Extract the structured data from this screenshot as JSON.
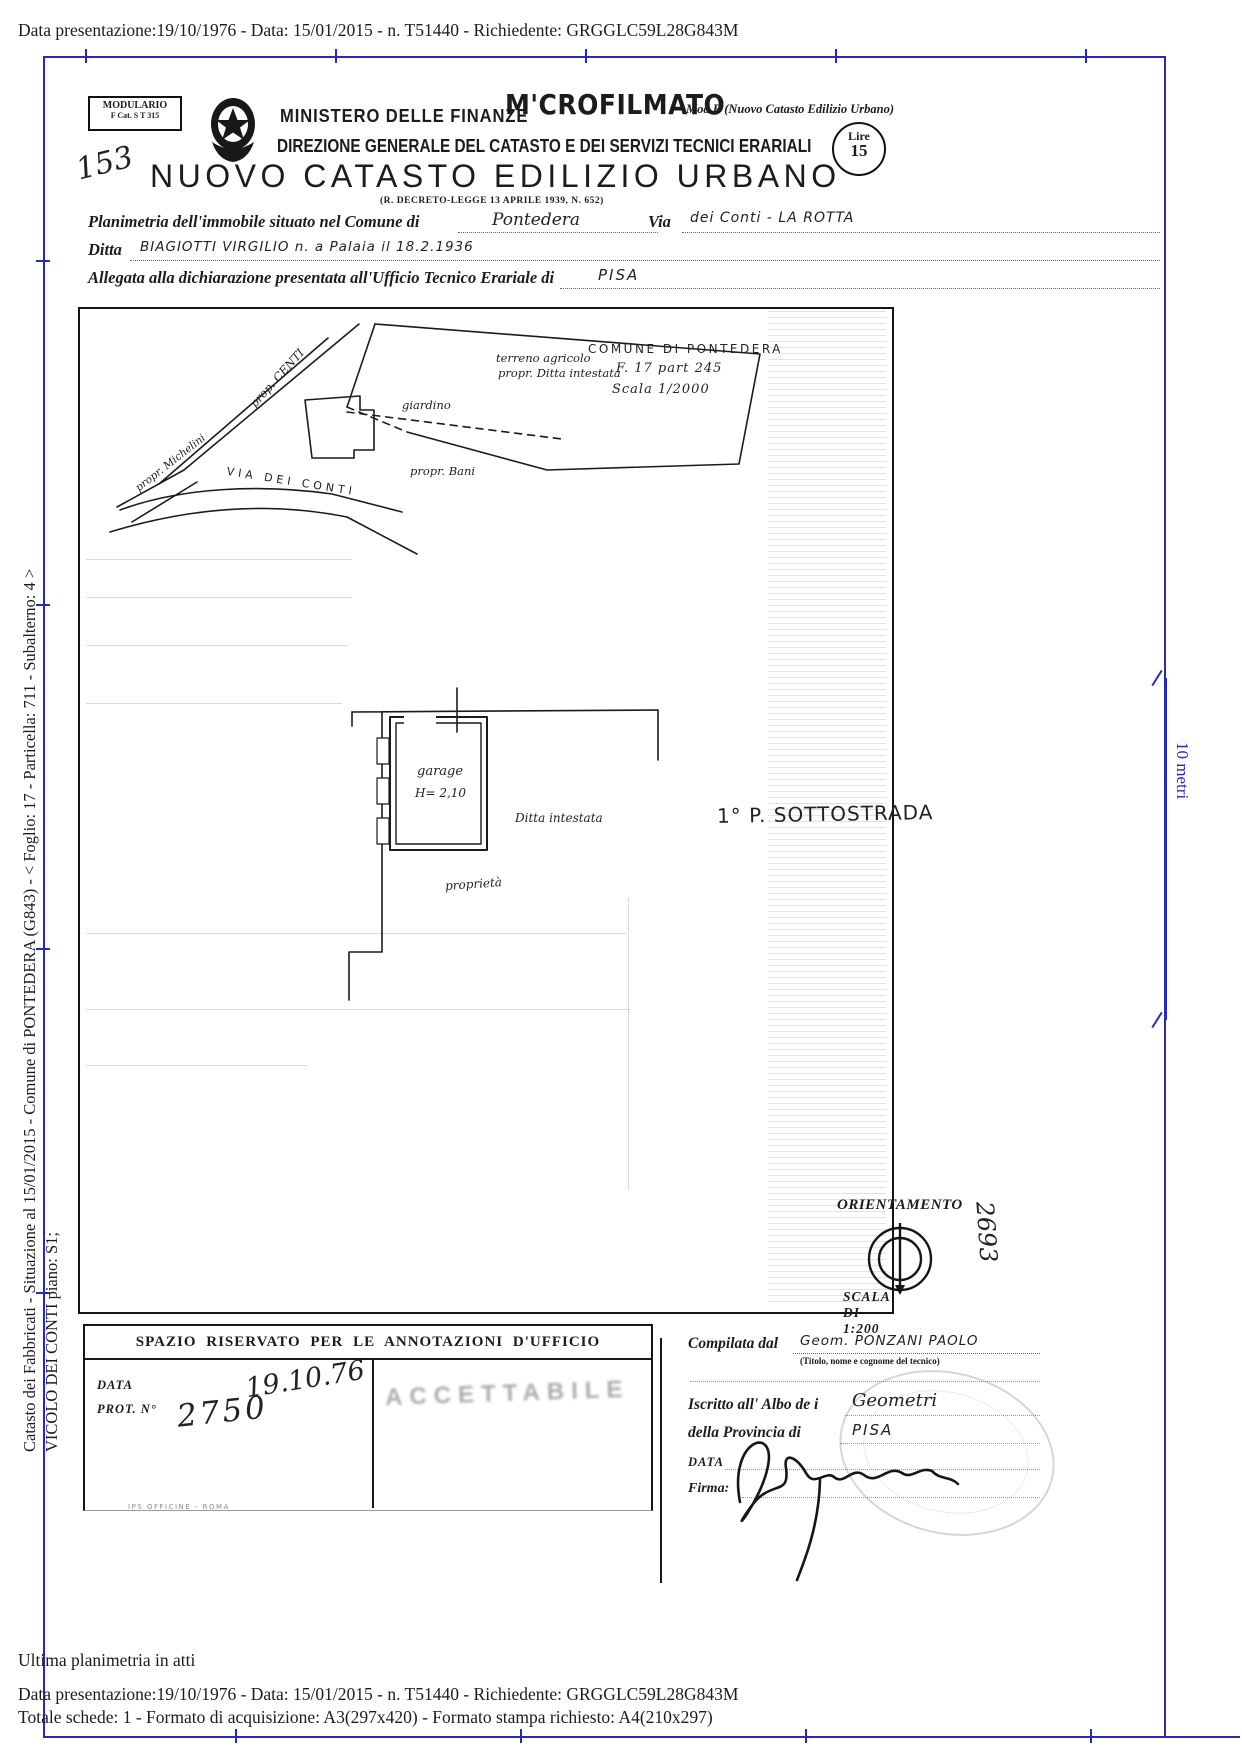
{
  "colors": {
    "frame_blue": "#2a2ab0",
    "ink": "#1c1c1c"
  },
  "meta": {
    "top_line": "Data presentazione:19/10/1976 - Data: 15/01/2015 - n. T51440 - Richiedente: GRGGLC59L28G843M"
  },
  "margin": {
    "left_line1": "Catasto dei Fabbricati - Situazione al 15/01/2015 - Comune di PONTEDERA (G843) - <  Foglio: 17 - Particella: 711 - Subalterno: 4 >",
    "left_line2": "VICOLO DEI CONTI piano: S1;"
  },
  "ruler": {
    "label": "10 metri"
  },
  "header": {
    "modulario_title": "MODULARIO",
    "modulario_sub": "F    Cat. S T    315",
    "ministero": "MINISTERO DELLE FINANZE",
    "microfilmato": "M'CROFILMATO",
    "mod_b": "Mod B (Nuovo Catasto Edilizio Urbano)",
    "direzione": "DIREZIONE GENERALE DEL CATASTO E DEI SERVIZI TECNICI ERARIALI",
    "lire_top": "Lire",
    "lire_value": "15",
    "hand_number": "153",
    "title": "NUOVO CATASTO EDILIZIO URBANO",
    "subtitle": "(R. DECRETO-LEGGE 13 APRILE 1939, N. 652)"
  },
  "form": {
    "planimetria_label": "Planimetria dell'immobile situato nel Comune di",
    "comune_value": "Pontedera",
    "via_label": "Via",
    "via_value": "dei Conti - LA ROTTA",
    "ditta_label": "Ditta",
    "ditta_value": "BIAGIOTTI VIRGILIO  n. a Palaia il 18.2.1936",
    "allegata_label": "Allegata alla dichiarazione presentata all'Ufficio Tecnico Erariale di",
    "ufficio_value": "PISA"
  },
  "plan": {
    "site": {
      "prop_centi": "prop. CENTI",
      "terreno1": "terreno agricolo",
      "terreno2": "propr. Ditta intestata",
      "giardino": "giardino",
      "michelini": "propr. Michelini",
      "via_conti": "VIA DEI CONTI",
      "bani": "propr. Bani",
      "comune": "COMUNE DI PONTEDERA",
      "foglio": "F. 17  part 245",
      "scala": "Scala 1/2000"
    },
    "garage": {
      "name": "garage",
      "height": "H= 2,10",
      "ditta": "Ditta  intestata",
      "proprieta": "proprietà"
    },
    "piano": "1° P. SOTTOSTRADA",
    "orientamento": "ORIENTAMENTO",
    "scala_dis": "SCALA DI 1:200",
    "side_number": "2693"
  },
  "annot": {
    "header": "SPAZIO RISERVATO PER LE ANNOTAZIONI D'UFFICIO",
    "data_label": "DATA",
    "prot_label": "PROT. N°",
    "data_value": "19.10.76",
    "prot_value": "2750",
    "stamp": "ACCETTABILE",
    "printer": "IPS OFFICINE - ROMA"
  },
  "comp": {
    "compilata_label": "Compilata dal",
    "compilata_value": "Geom. PONZANI PAOLO",
    "caption": "(Titolo, nome e cognome del tecnico)",
    "iscritto_label": "Iscritto all' Albo de i",
    "iscritto_value": "Geometri",
    "provincia_label": "della Provincia di",
    "provincia_value": "PISA",
    "data_label": "DATA",
    "firma_label": "Firma:"
  },
  "footer": {
    "ultima": "Ultima planimetria in atti",
    "line1": "Data presentazione:19/10/1976 - Data: 15/01/2015 - n. T51440 - Richiedente: GRGGLC59L28G843M",
    "line2": "Totale schede: 1 - Formato di acquisizione: A3(297x420)  - Formato stampa richiesto: A4(210x297)"
  }
}
